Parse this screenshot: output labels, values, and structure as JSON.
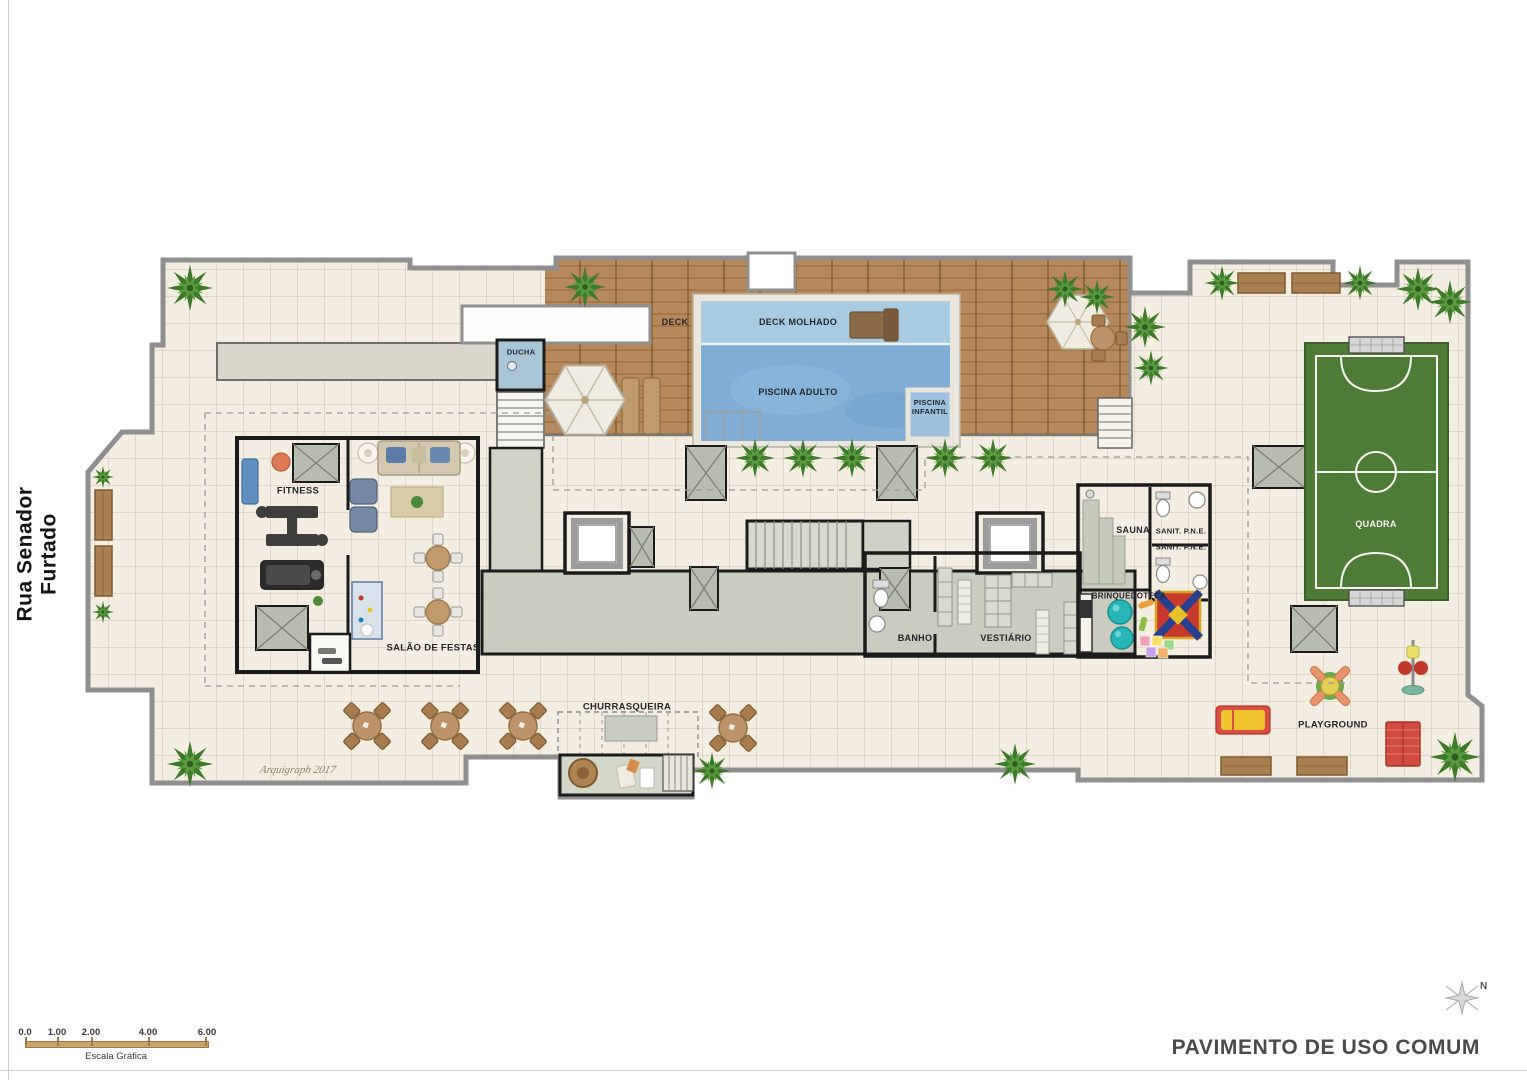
{
  "page": {
    "street_label": "Rua Senador Furtado",
    "title": "PAVIMENTO DE USO COMUM",
    "signature": "Arquigraph 2017",
    "compass_north": "N"
  },
  "scale_bar": {
    "caption": "Escala Gráfica",
    "ticks": [
      "0.0",
      "1.00",
      "2.00",
      "4.00",
      "6.00"
    ]
  },
  "rooms": {
    "deck": "DECK",
    "deck_molhado": "DECK MOLHADO",
    "piscina_adulto": "PISCINA ADULTO",
    "piscina_infantil": "PISCINA INFANTIL",
    "ducha": "DUCHA",
    "fitness": "FITNESS",
    "salao_de_festas": "SALÃO DE FESTAS",
    "sauna": "SAUNA",
    "sanit_pne_1": "SANIT. P.N.E.",
    "sanit_pne_2": "SANIT. P.N.E.",
    "brinquedoteca": "BRINQUEDOTECA",
    "banho": "BANHO",
    "vestiario": "VESTIÁRIO",
    "churrasqueira": "CHURRASQUEIRA",
    "quadra": "QUADRA",
    "playground": "PLAYGROUND"
  },
  "colors": {
    "floor": "#f3ede2",
    "deck_wood": "#b6885a",
    "pool_water": "#7fadd6",
    "wet_deck_water": "#a9cbe2",
    "kids_pool_water": "#9cc0de",
    "court_green": "#4e7b36",
    "corridor_floor": "#c9ccbe",
    "wall": "#1b1b1b",
    "outline": "#8f8f8f"
  }
}
